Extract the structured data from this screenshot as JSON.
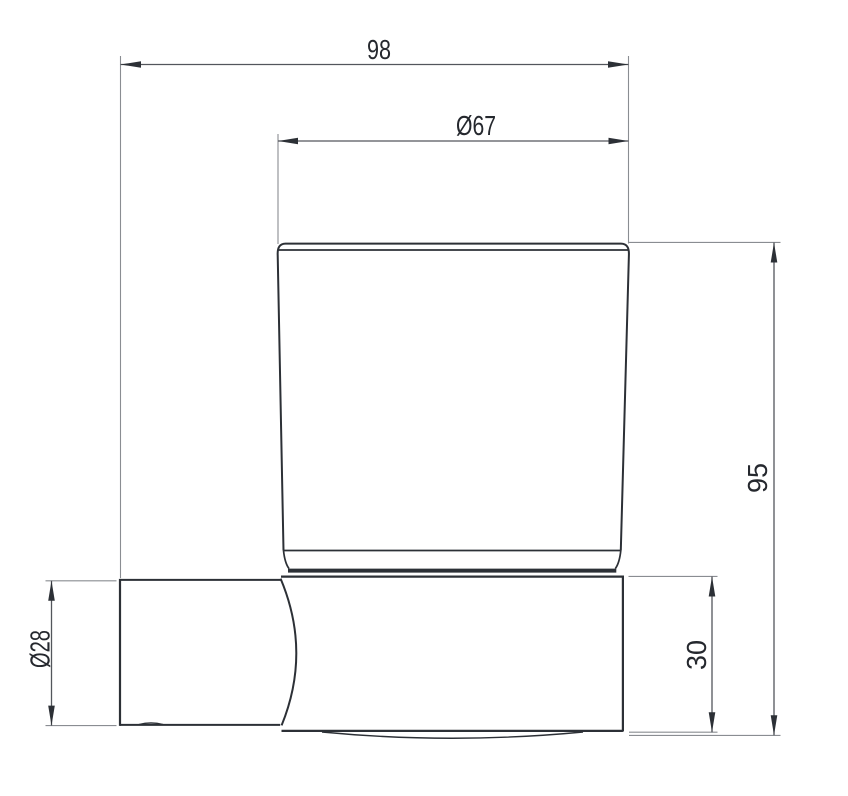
{
  "drawing": {
    "labels": {
      "total_depth": "98",
      "cup_diameter": "Ø67",
      "overall_height": "95",
      "holder_height": "30",
      "arm_diameter": "Ø28"
    },
    "colors": {
      "object_line": "#2c3036",
      "dimension_line": "#53565c",
      "extension_line": "#8a8d92",
      "label_text": "#25282e",
      "background": "#ffffff"
    }
  }
}
